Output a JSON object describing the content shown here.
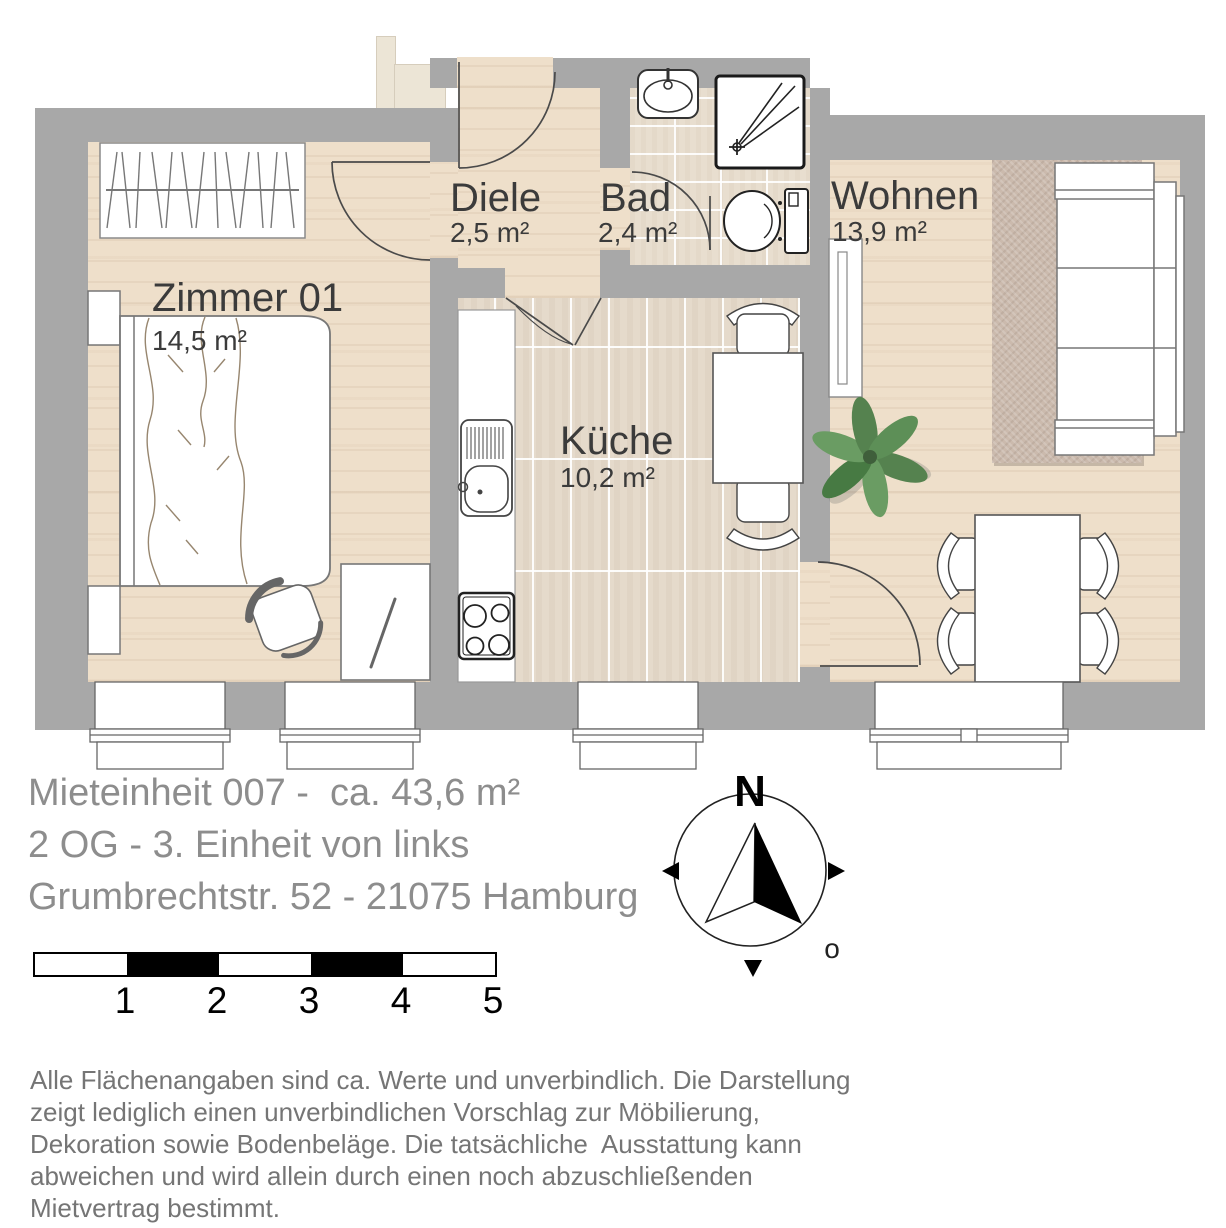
{
  "plan": {
    "rooms": [
      {
        "name": "Zimmer 01",
        "area": "14,5 m²"
      },
      {
        "name": "Diele",
        "area": "2,5 m²"
      },
      {
        "name": "Bad",
        "area": "2,4 m²"
      },
      {
        "name": "Küche",
        "area": "10,2 m²"
      },
      {
        "name": "Wohnen",
        "area": "13,9 m²"
      }
    ]
  },
  "title": {
    "lines": [
      "Mieteinheit 007 -  ca. 43,6 m²",
      "2 OG - 3. Einheit von links",
      "Grumbrechtstr. 52 - 21075 Hamburg"
    ]
  },
  "compass": {
    "north_label": "N",
    "east_label": "o"
  },
  "scale_bar": {
    "labels": [
      "1",
      "2",
      "3",
      "4",
      "5"
    ]
  },
  "disclaimer": {
    "lines": [
      "Alle Flächenangaben sind ca. Werte und unverbindlich. Die Darstellung",
      "zeigt lediglich einen unverbindlichen Vorschlag zur Möbilierung,",
      "Dekoration sowie Bodenbeläge. Die tatsächliche  Ausstattung kann",
      "abweichen und wird allein durch einen noch abzuschließenden",
      "Mietvertrag bestimmt."
    ]
  },
  "colors": {
    "wall": "#a8a8a8",
    "wood": "#eedfca",
    "tile": "#e5dacb",
    "rug": "#cbbaad",
    "room_label": "#3b3b3b",
    "title_text": "#8d8d8d",
    "disclaimer_text": "#757575"
  }
}
